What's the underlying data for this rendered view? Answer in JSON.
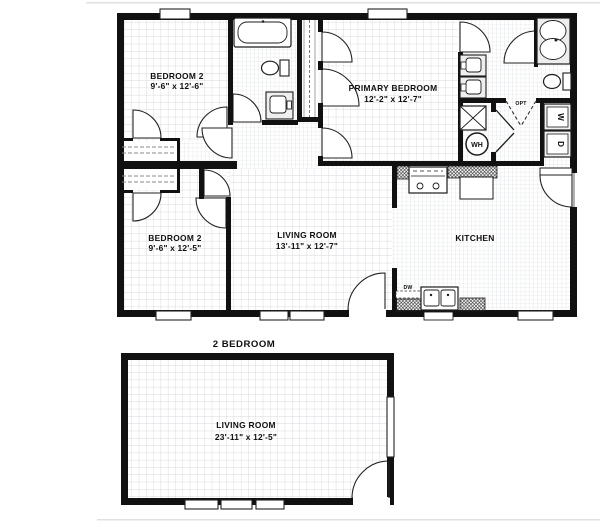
{
  "plan_caption": "2 BEDROOM",
  "upper_plan": {
    "bedroom2_top": {
      "name": "BEDROOM 2",
      "dims": "9'-6\" x 12'-6\""
    },
    "primary_bedroom": {
      "name": "PRIMARY BEDROOM",
      "dims": "12'-2\" x 12'-7\""
    },
    "bedroom2_bottom": {
      "name": "BEDROOM 2",
      "dims": "9'-6\" x 12'-5\""
    },
    "living_room": {
      "name": "LIVING ROOM",
      "dims": "13'-11\" x 12'-7\""
    },
    "kitchen": {
      "name": "KITCHEN"
    },
    "labels": {
      "water_heater": "WH",
      "washer": "W",
      "dryer": "D",
      "opt_door": "OPT",
      "dishwasher": "DW"
    }
  },
  "lower_plan": {
    "living_room": {
      "name": "LIVING ROOM",
      "dims": "23'-11\" x 12'-5\""
    }
  },
  "colors": {
    "wall": "#111111",
    "grid_major": "#c9cdd3",
    "grid_fine": "#d3d7db",
    "background": "#ffffff",
    "divider": "#e0e0e0",
    "fixture_fill": "#efefef"
  }
}
